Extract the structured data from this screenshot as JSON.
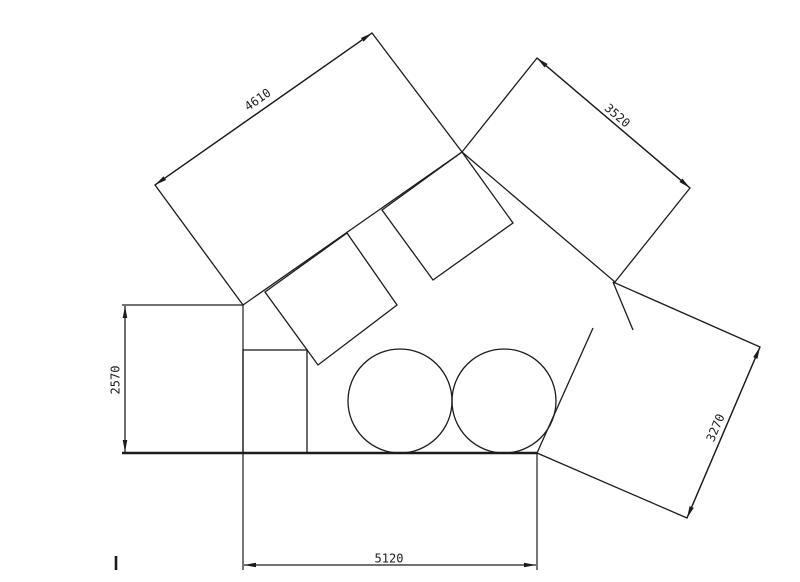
{
  "title": "technical-dimension-drawing",
  "canvas": {
    "width": 800,
    "height": 582,
    "background": "#ffffff",
    "stroke_color": "#1c1c1c",
    "line_width": 1.3
  },
  "shapes": {
    "polygons": [
      {
        "name": "large-rotated-rect-top-left",
        "points": "155,185 372,33 462,152 243,305"
      },
      {
        "name": "rotated-rect-top-right",
        "points": "462,152 537,58 690,188 615,282"
      },
      {
        "name": "small-rotated-square-left",
        "points": "347,233 397,305 318,365 265,292"
      },
      {
        "name": "small-rotated-square-right",
        "points": "382,210 462,152 513,223 433,280"
      }
    ],
    "paths": [
      {
        "name": "rotated-rect-bottom-right-outline",
        "d": "M593,328 L537,453 L687,518 L760,347 L613,282",
        "w": 1.3
      },
      {
        "name": "stray-corner-segment",
        "d": "M613,282 L633,330",
        "w": 1.3
      }
    ],
    "lines": [
      {
        "name": "extension-line-top-horizontal",
        "x1": 122,
        "y1": 305,
        "x2": 243,
        "y2": 305,
        "w": 1.2
      },
      {
        "name": "extension-line-left-vertical",
        "x1": 243,
        "y1": 305,
        "x2": 243,
        "y2": 570,
        "w": 1.2
      },
      {
        "name": "ground-line",
        "x1": 122,
        "y1": 453,
        "x2": 537,
        "y2": 453,
        "w": 2.4
      },
      {
        "name": "extension-line-right-vertical",
        "x1": 537,
        "y1": 453,
        "x2": 537,
        "y2": 570,
        "w": 1.2
      },
      {
        "name": "tick-mark-bottom-left",
        "x1": 116,
        "y1": 556,
        "x2": 116,
        "y2": 570,
        "w": 2.6
      }
    ],
    "rects": [
      {
        "name": "small-rectangle-on-ground",
        "x": 243,
        "y": 350,
        "width": 64,
        "height": 103
      }
    ],
    "circles": [
      {
        "name": "circle-left",
        "cx": 400,
        "cy": 401,
        "r": 52
      },
      {
        "name": "circle-right",
        "cx": 504,
        "cy": 401,
        "r": 52
      }
    ]
  },
  "dimensions": [
    {
      "name": "dimension-4610",
      "label": "4610",
      "x1": 155,
      "y1": 185,
      "x2": 372,
      "y2": 33,
      "tx": 258,
      "ty": 100,
      "angle": -35
    },
    {
      "name": "dimension-3520",
      "label": "3520",
      "x1": 537,
      "y1": 58,
      "x2": 690,
      "y2": 188,
      "tx": 617,
      "ty": 116,
      "angle": 40.5
    },
    {
      "name": "dimension-3270",
      "label": "3270",
      "x1": 760,
      "y1": 347,
      "x2": 687,
      "y2": 518,
      "tx": 716,
      "ty": 428,
      "angle": -67
    },
    {
      "name": "dimension-2570",
      "label": "2570",
      "x1": 125,
      "y1": 306,
      "x2": 125,
      "y2": 452,
      "tx": 116,
      "ty": 380,
      "angle": -90
    },
    {
      "name": "dimension-5120",
      "label": "5120",
      "x1": 244,
      "y1": 565,
      "x2": 536,
      "y2": 565,
      "tx": 389,
      "ty": 559,
      "angle": 0
    }
  ]
}
